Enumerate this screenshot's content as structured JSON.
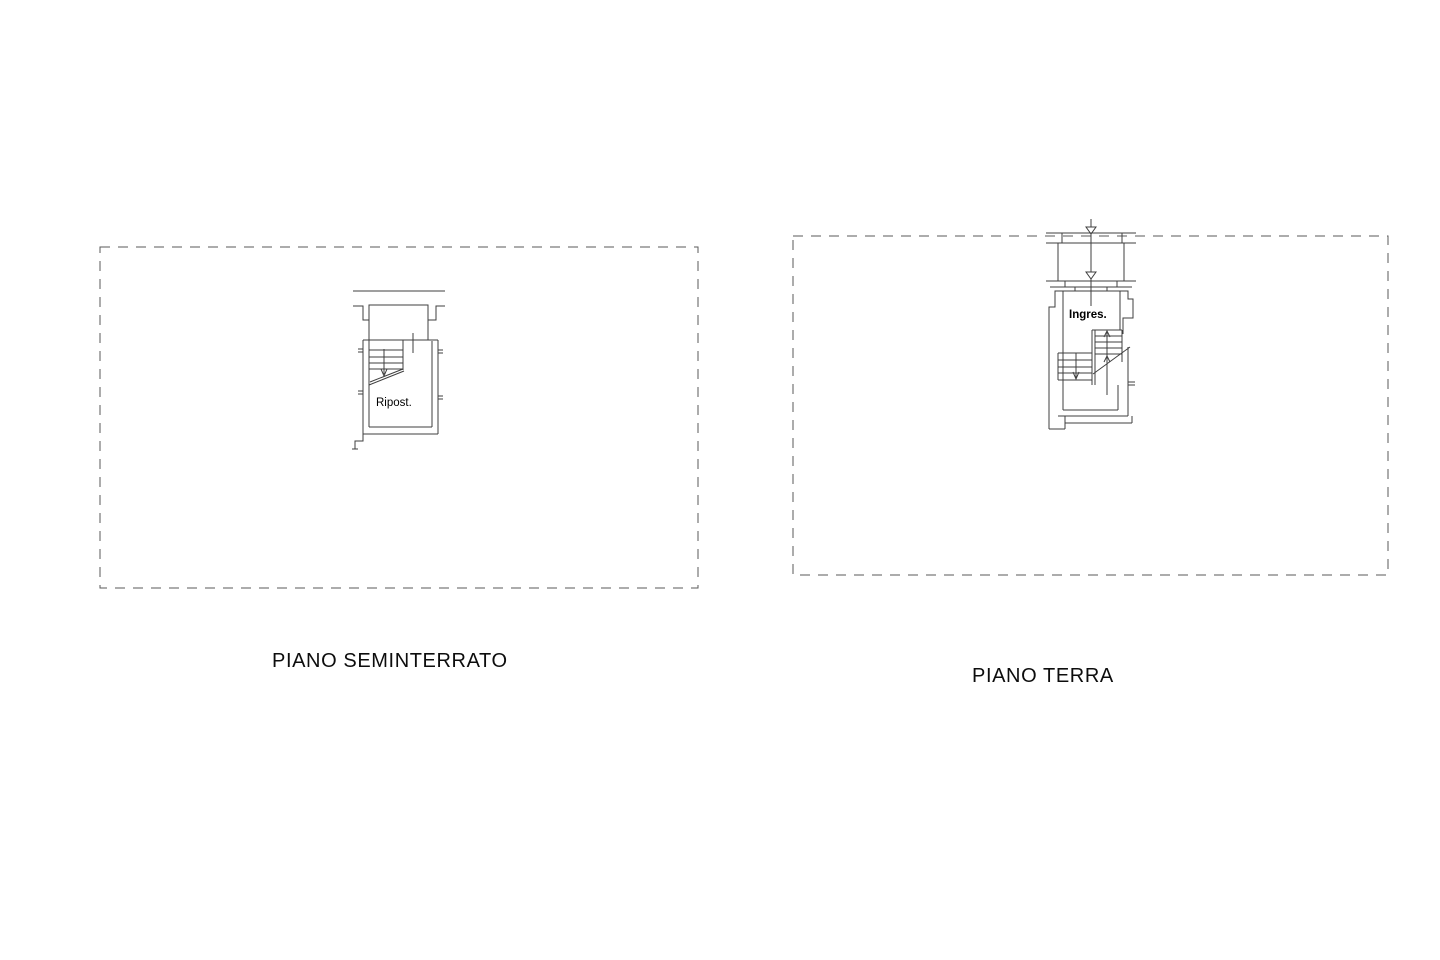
{
  "document": {
    "type": "floor-plan-sheet",
    "background_color": "#ffffff",
    "line_color": "#3f3f3f",
    "dash_border_color": "#5a5a5a",
    "text_color": "#000000"
  },
  "plans": {
    "seminterrato": {
      "title": "PIANO SEMINTERRATO",
      "room_label": "Ripost."
    },
    "terra": {
      "title": "PIANO TERRA",
      "room_label": "Ingres."
    }
  }
}
